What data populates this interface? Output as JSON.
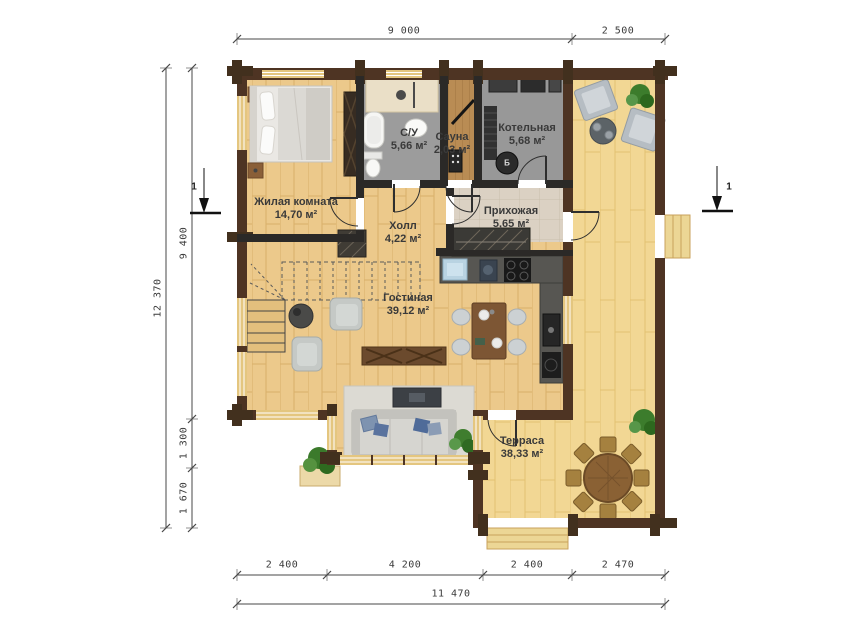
{
  "plan": {
    "section_marker_left": "1",
    "section_marker_right": "1",
    "boiler_mark": "Б"
  },
  "dimensions": {
    "top": [
      "9 000",
      "2 500"
    ],
    "left_total": "12 370",
    "left": [
      "9 400",
      "1 300",
      "1 670"
    ],
    "bottom": [
      "2 400",
      "4 200",
      "2 400",
      "2 470"
    ],
    "bottom_total": "11 470"
  },
  "rooms": [
    {
      "name": "Жилая комната",
      "area": "14,70 м²"
    },
    {
      "name": "С/У",
      "area": "5,66 м²"
    },
    {
      "name": "Сауна",
      "area": "2,03 м²"
    },
    {
      "name": "Котельная",
      "area": "5,68 м²"
    },
    {
      "name": "Прихожая",
      "area": "5,65 м²"
    },
    {
      "name": "Холл",
      "area": "4,22 м²"
    },
    {
      "name": "Гостиная",
      "area": "39,12 м²"
    },
    {
      "name": "Терраса",
      "area": "38,33 м²"
    }
  ],
  "colors": {
    "wall": "#4e3423",
    "interior_wall": "#2b2927",
    "wood_floor": "#ecc98b",
    "terrace_floor": "#f2d794",
    "tile_floor": "#dbd1c3",
    "wet_floor": "#9c9c9c",
    "dimension_text": "#3a3a3a"
  }
}
